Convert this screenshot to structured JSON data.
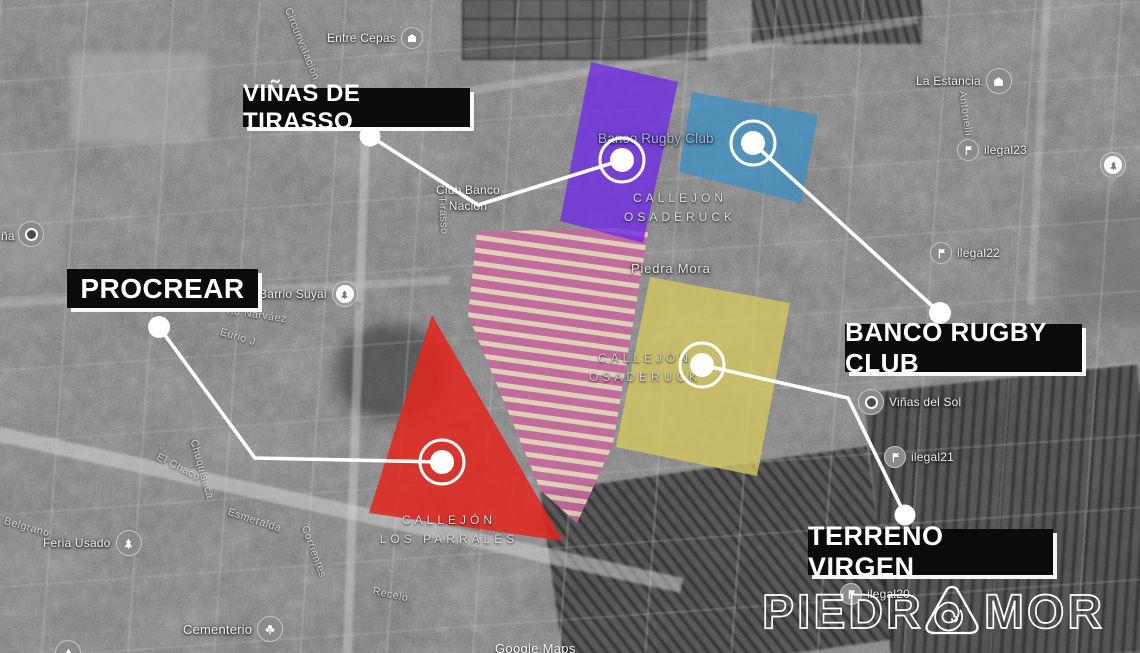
{
  "callouts": {
    "vinas": {
      "label": "VIÑAS DE TIRASSO"
    },
    "procrear": {
      "label": "PROCREAR"
    },
    "banco": {
      "label": "BANCO RUGBY CLUB"
    },
    "terreno": {
      "label": "TERRENO VIRGEN"
    }
  },
  "regions": {
    "vinas_parcel": {
      "name": "Viñas de Tirasso parcel",
      "overlay_color": "#6f2ee2"
    },
    "banco_parcel": {
      "name": "Banco Rugby Club parcel",
      "overlay_color": "#3b90c4"
    },
    "terreno_parcel": {
      "name": "Terreno Virgen parcel",
      "overlay_color": "#d5c75f"
    },
    "procrear_parcel": {
      "name": "Procrear parcel",
      "overlay_color": "#e3251c"
    },
    "subdivision_parcel": {
      "name": "Urbanization parcel",
      "overlay_color": "#c9669f",
      "road_color": "#e9d8bd"
    }
  },
  "pois": [
    {
      "label": "Entre Cepas",
      "icon": "building-icon"
    },
    {
      "label": "La Estancia",
      "icon": "building-icon"
    },
    {
      "label": "ilegal23",
      "icon": "flag-icon"
    },
    {
      "label": "ilegal22",
      "icon": "flag-icon"
    },
    {
      "label": "ilegal21",
      "icon": "flag-icon"
    },
    {
      "label": "ilegal20",
      "icon": "flag-icon"
    },
    {
      "label": "Viñas del Sol",
      "icon": "place-pin-icon"
    },
    {
      "label": "Barrio Suyai",
      "icon": "tree-pin-icon"
    },
    {
      "label": "Feria Usado",
      "icon": "tree-icon"
    },
    {
      "label": "Cementerio",
      "icon": "cemetery-icon"
    }
  ],
  "map_places": {
    "piedra_mora": "Piedra Mora",
    "banco_rugby_club": "Banco Rugby Club",
    "club_banco_line1": "Club Banco",
    "club_banco_line2": "Nación"
  },
  "roads": {
    "osaderuck_north": {
      "line1": "CALLEJÓN",
      "line2": "OSADERUCK"
    },
    "osaderuck_south": {
      "line1": "CALLEJÓN",
      "line2": "OSADERUCK"
    },
    "los_parrales": {
      "line1": "CALLEJÓN",
      "line2": "LOS PARRALES"
    },
    "streets": [
      "Circunvalación",
      "Antonelli",
      "Tirasso",
      "Esmeralda",
      "Belgrano",
      "Corrientes",
      "Chuquisaca",
      "El Chaco",
      "Eurio J",
      "rio Narváez",
      "Recelo",
      "ña"
    ]
  },
  "watermark": {
    "label": "Google Maps"
  },
  "brand": {
    "wordmark_left": "PIEDR",
    "wordmark_right": "MORA",
    "full_name": "PIEDRA MORA"
  }
}
